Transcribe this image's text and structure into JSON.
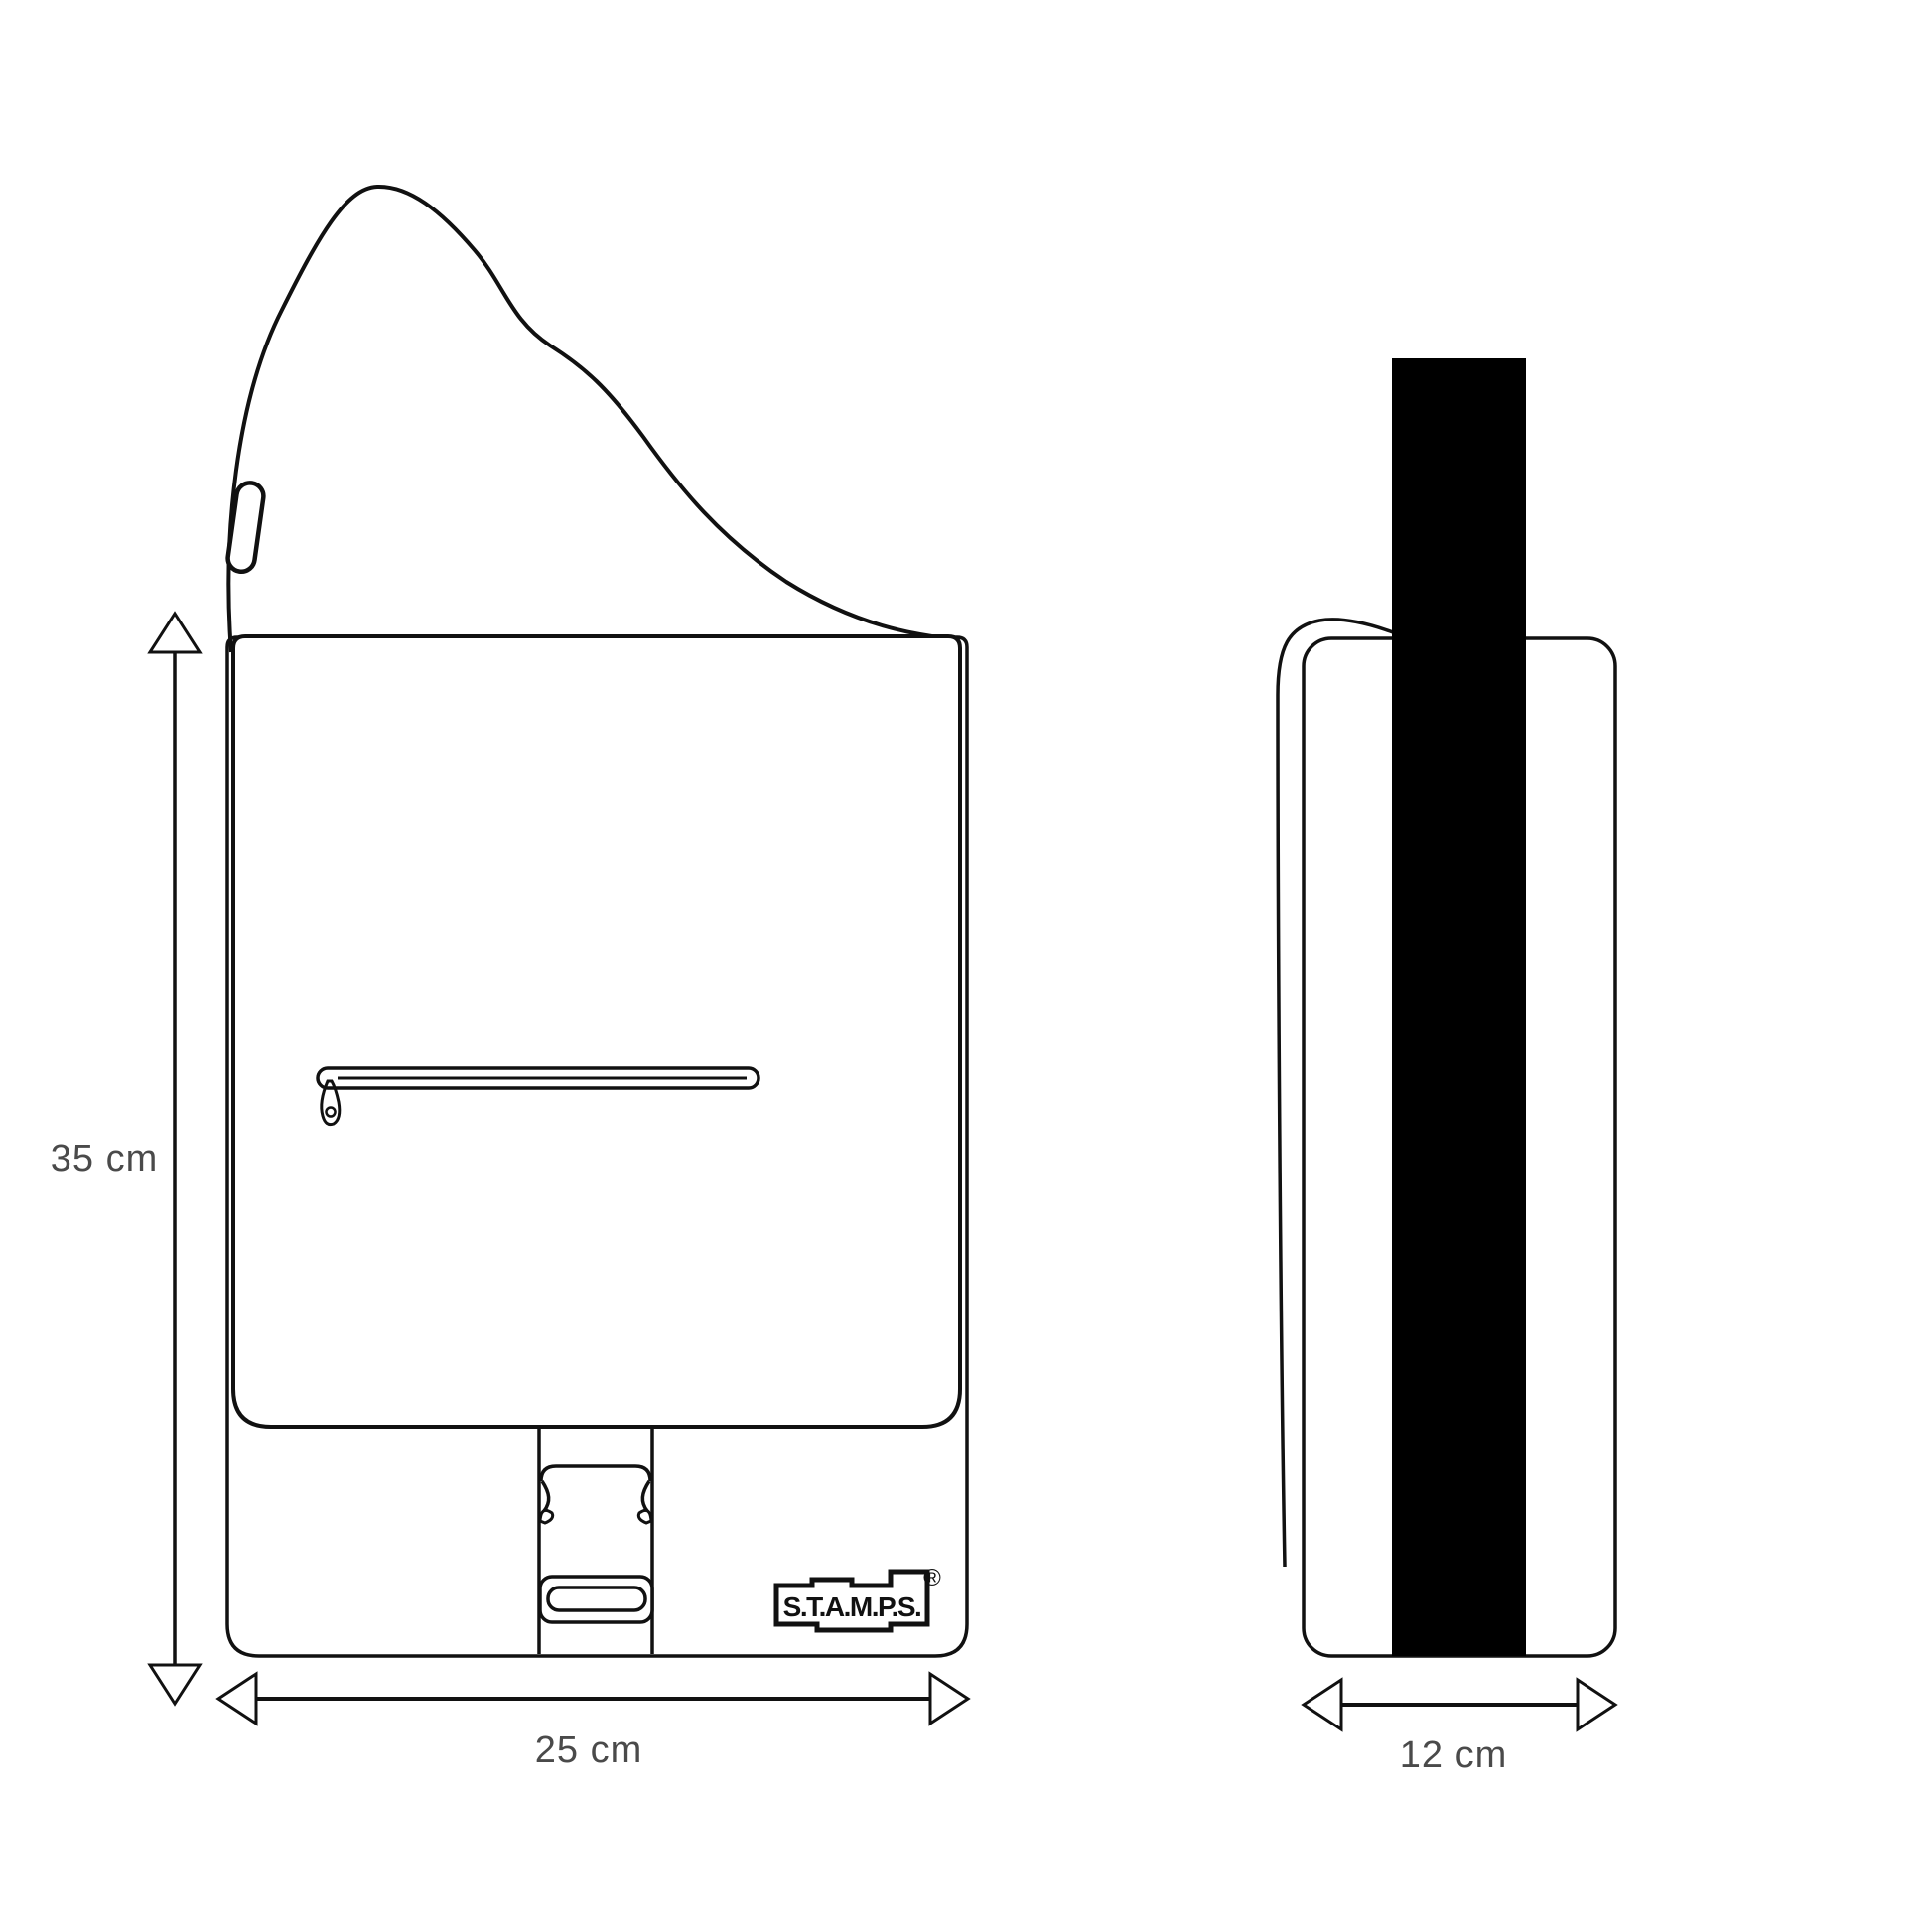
{
  "diagram": {
    "front_view": {
      "height_label": "35 cm",
      "width_label": "25 cm",
      "brand": "S.T.A.M.P.S.",
      "registered_mark": "®"
    },
    "side_view": {
      "width_label": "12 cm"
    },
    "colors": {
      "line": "#111111",
      "strap_fill": "#000000",
      "dimension_text": "#4a4a4a",
      "background": "#ffffff"
    }
  }
}
